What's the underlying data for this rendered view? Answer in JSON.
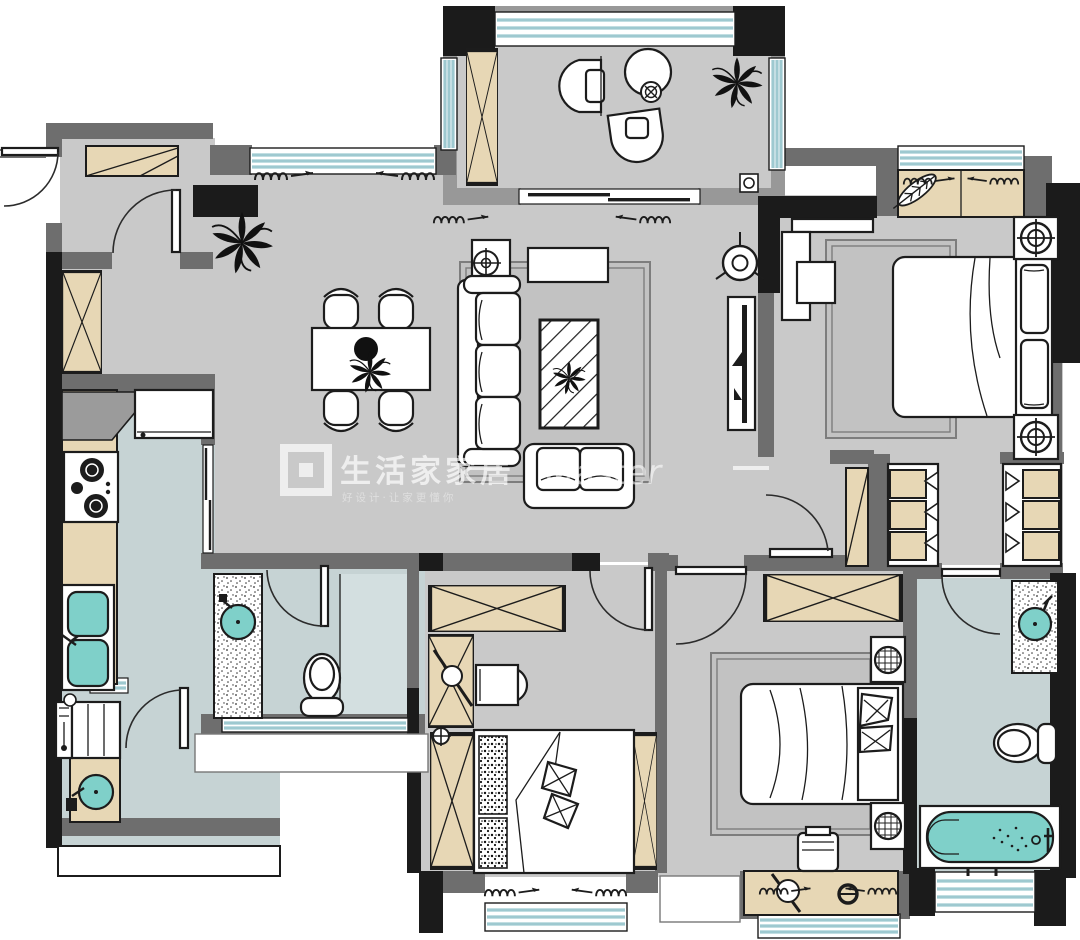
{
  "watermark": {
    "logo_text": "生活家家居",
    "tagline": "好设计·让家更懂你",
    "script_text": "Master",
    "dash_left": "",
    "dash_right": ""
  },
  "palette": {
    "background": "#ffffff",
    "floor_main": "#c9c9c9",
    "floor_wet": "#c6d3d4",
    "shower_floor": "#d3dfe0",
    "wall_dark": "#1b1b1b",
    "wall_gray": "#6e6e6e",
    "wall_light": "#989898",
    "wood": "#e7d7b5",
    "window_glass": "#9ec9d0",
    "fixture_teal": "#7fd0c9",
    "rug": "#c2c2c2",
    "outline": "#1c1c1c"
  },
  "plan": {
    "type": "apartment-floor-plan",
    "rooms": [
      {
        "name": "balcony",
        "furniture": [
          "lounge-chair",
          "lounge-chair",
          "round-table",
          "cup",
          "plant",
          "storage-cabinet",
          "floor-drain",
          "sliding-door"
        ]
      },
      {
        "name": "entry-foyer",
        "furniture": [
          "shoe-cabinet",
          "entry-door",
          "inner-door",
          "tall-cabinet"
        ]
      },
      {
        "name": "dining-area",
        "furniture": [
          "dining-table",
          "dining-chair x4",
          "centerpiece-plant",
          "floor-plant"
        ]
      },
      {
        "name": "living-room",
        "furniture": [
          "three-seat-sofa",
          "loveseat",
          "coffee-table",
          "side-table",
          "table-lamp",
          "console-table",
          "tv-panel",
          "ceiling-fan",
          "rug",
          "curtains"
        ]
      },
      {
        "name": "kitchen",
        "furniture": [
          "fridge",
          "corner-counter",
          "cooktop",
          "double-sink",
          "pocket-door"
        ]
      },
      {
        "name": "utility-laundry",
        "furniture": [
          "washing-machine",
          "laundry-sink",
          "door"
        ]
      },
      {
        "name": "bathroom-1",
        "furniture": [
          "vanity-sink",
          "toilet",
          "shower-area",
          "window",
          "door"
        ]
      },
      {
        "name": "bedroom-2-study",
        "furniture": [
          "wardrobe",
          "desk",
          "desk-chair",
          "tatami-bed",
          "cushions",
          "bay-window",
          "door"
        ]
      },
      {
        "name": "hallway-closet",
        "furniture": [
          "wardrobe-left",
          "wardrobe-right"
        ]
      },
      {
        "name": "master-bedroom",
        "furniture": [
          "double-bed",
          "pillows",
          "nightstand x2",
          "table-lamp x2",
          "rug",
          "tv-cabinet",
          "shelf",
          "bay-window",
          "feather-decor",
          "door"
        ]
      },
      {
        "name": "bedroom-3",
        "furniture": [
          "wardrobe",
          "double-bed",
          "pillows",
          "nightstand x2",
          "potted-plant x2",
          "stool",
          "rug",
          "bay-window",
          "door"
        ]
      },
      {
        "name": "bathroom-2",
        "furniture": [
          "vanity-sink",
          "toilet",
          "bathtub",
          "window",
          "door"
        ]
      }
    ]
  }
}
